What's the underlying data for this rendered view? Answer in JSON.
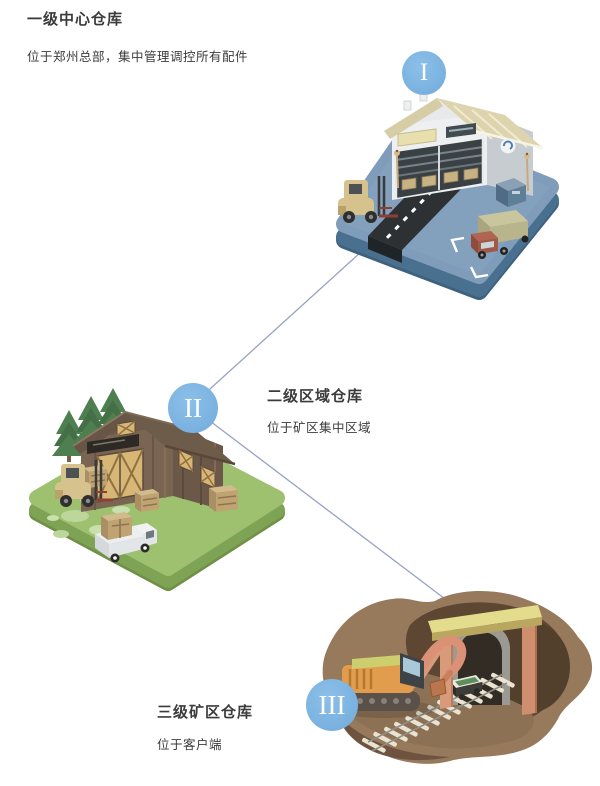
{
  "diagram": {
    "background": "#ffffff",
    "connector_color": "#97a1c5",
    "node_circle_color": "#7db4e1",
    "node_numeral_color": "#ffffff",
    "text_color": "#3b3b3b"
  },
  "nodes": [
    {
      "numeral": "I",
      "title": "一级中心仓库",
      "subtitle": "位于郑州总部，集中管理调控所有配件",
      "illustration": "headquarters-warehouse"
    },
    {
      "numeral": "II",
      "title": "二级区域仓库",
      "subtitle": "位于矿区集中区域",
      "illustration": "regional-barn-warehouse"
    },
    {
      "numeral": "III",
      "title": "三级矿区仓库",
      "subtitle": "位于客户端",
      "illustration": "mine-site-warehouse"
    }
  ]
}
